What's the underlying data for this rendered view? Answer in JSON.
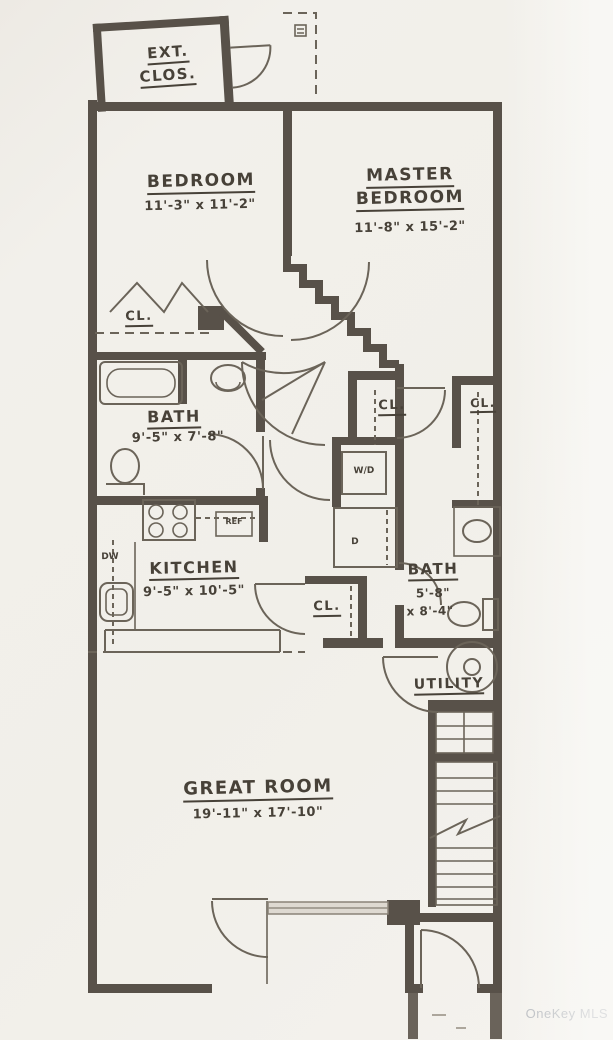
{
  "title": "Floor plan (scanned architectural drawing)",
  "watermark": "OneKey MLS",
  "colors": {
    "paper": "#f1efea",
    "wall": "#585149",
    "line": "#6b6459",
    "text": "#474138",
    "watermark": "#b4b7bc"
  },
  "labels": {
    "ext_clos_line1": "EXT.",
    "ext_clos_line2": "CLOS.",
    "bedroom_name": "BEDROOM",
    "bedroom_dims": "11'-3\" x 11'-2\"",
    "master_name_line1": "MASTER",
    "master_name_line2": "BEDROOM",
    "master_dims": "11'-8\" x 15'-2\"",
    "bath1_name": "BATH",
    "bath1_dims": "9'-5\" x 7'-8\"",
    "kitchen_name": "KITCHEN",
    "kitchen_dims": "9'-5\" x 10'-5\"",
    "bath2_name": "BATH",
    "bath2_dims_line1": "5'-8\"",
    "bath2_dims_line2": "x 8'-4\"",
    "utility_name": "UTILITY",
    "great_room_name": "GREAT ROOM",
    "great_room_dims": "19'-11\" x 17'-10\"",
    "closet_bedroom": "CL.",
    "closet_hall": "CL.",
    "closet_master": "CL.",
    "closet_kitchen": "CL.",
    "washer_dryer": "W/D",
    "dryer": "D",
    "dishwasher": "DW",
    "refrigerator": "REF"
  }
}
